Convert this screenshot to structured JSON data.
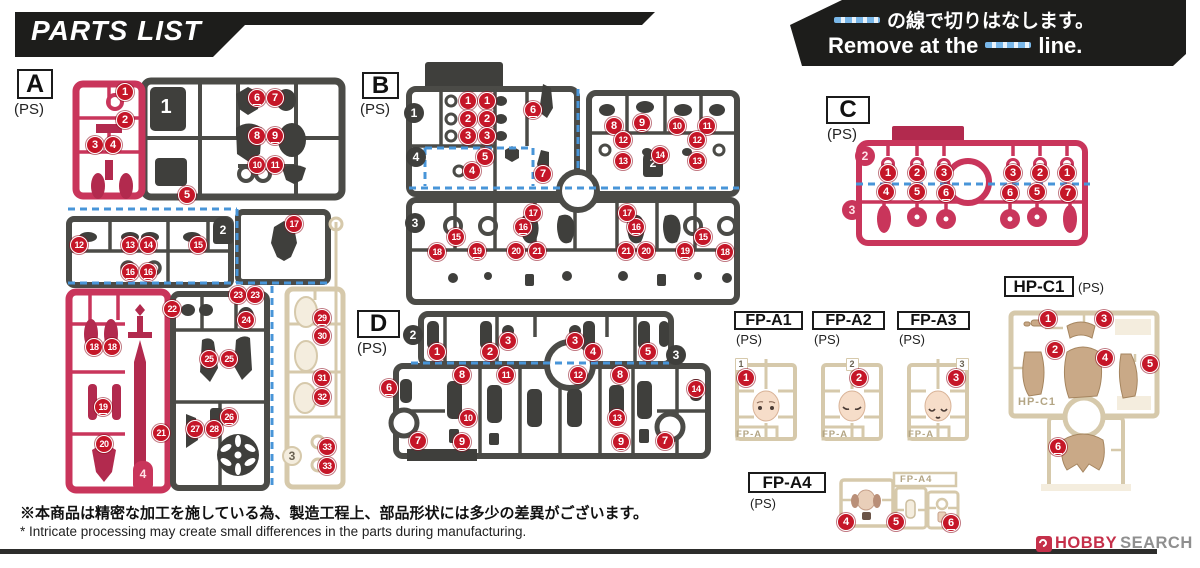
{
  "header": {
    "title": "PARTS LIST",
    "cut_note": {
      "jp": "の線で切りはなします。",
      "en_before": "Remove at the",
      "en_after": "line."
    }
  },
  "colors": {
    "pink": "#c9355b",
    "pink_dark": "#b22a4e",
    "dark": "#4b4b47",
    "dark_part": "#3f3f3c",
    "cream": "#d6c9ab",
    "cream_fill": "#f4edde",
    "skin": "#f6ddc9",
    "hair": "#c9a987",
    "marker": "#c51628",
    "cut_line": "#4895d8",
    "banner": "#1d1d1b",
    "logo_red": "#c5304a",
    "logo_gray": "#8f8f8f"
  },
  "labels": {
    "A": {
      "t": "A",
      "ps": "(PS)"
    },
    "B": {
      "t": "B",
      "ps": "(PS)"
    },
    "C": {
      "t": "C",
      "ps": "(PS)"
    },
    "D": {
      "t": "D",
      "ps": "(PS)"
    },
    "FPA1": {
      "t": "FP-A1",
      "ps": "(PS)"
    },
    "FPA2": {
      "t": "FP-A2",
      "ps": "(PS)"
    },
    "FPA3": {
      "t": "FP-A3",
      "ps": "(PS)"
    },
    "FPA4": {
      "t": "FP-A4",
      "ps": "(PS)"
    },
    "HPC1": {
      "t": "HP-C1",
      "ps": "(PS)"
    }
  },
  "molded_texts": [
    {
      "text": "FP-A",
      "x": 736,
      "y": 429
    },
    {
      "text": "FP-A",
      "x": 822,
      "y": 429
    },
    {
      "text": "FP-A",
      "x": 908,
      "y": 429
    },
    {
      "text": "FP-A4",
      "x": 900,
      "y": 474
    },
    {
      "text": "HP-C1",
      "x": 1018,
      "y": 396
    }
  ],
  "tags": [
    {
      "r": "A",
      "n": "1",
      "shape": "square",
      "color": "dark",
      "x": 166,
      "y": 107
    },
    {
      "r": "A",
      "n": "2",
      "shape": "tomb",
      "color": "dark",
      "x": 223,
      "y": 230
    },
    {
      "r": "A",
      "n": "3",
      "shape": "circle",
      "color": "cream",
      "x": 292,
      "y": 456
    },
    {
      "r": "A",
      "n": "4",
      "shape": "tomb",
      "color": "pink",
      "x": 143,
      "y": 474
    },
    {
      "r": "B",
      "n": "1",
      "shape": "circle",
      "color": "dark",
      "x": 414,
      "y": 113
    },
    {
      "r": "B",
      "n": "4",
      "shape": "circle",
      "color": "dark",
      "x": 416,
      "y": 157
    },
    {
      "r": "B",
      "n": "2",
      "shape": "tomb",
      "color": "dark",
      "x": 653,
      "y": 163
    },
    {
      "r": "B",
      "n": "3",
      "shape": "circle",
      "color": "dark",
      "x": 415,
      "y": 223
    },
    {
      "r": "C",
      "n": "2",
      "shape": "circle",
      "color": "pink",
      "x": 865,
      "y": 156
    },
    {
      "r": "C",
      "n": "3",
      "shape": "circle",
      "color": "pink",
      "x": 852,
      "y": 210
    },
    {
      "r": "D",
      "n": "2",
      "shape": "circle",
      "color": "dark",
      "x": 413,
      "y": 335
    },
    {
      "r": "D",
      "n": "3",
      "shape": "circle",
      "color": "dark",
      "x": 676,
      "y": 355
    },
    {
      "r": "FP-A1",
      "n": "1",
      "shape": "chip",
      "color": "chipc",
      "x": 741,
      "y": 364
    },
    {
      "r": "FP-A2",
      "n": "2",
      "shape": "chip",
      "color": "chipc",
      "x": 852,
      "y": 364
    },
    {
      "r": "FP-A3",
      "n": "3",
      "shape": "chip",
      "color": "chipc",
      "x": 962,
      "y": 364
    }
  ],
  "markers": [
    {
      "r": "A",
      "n": "1",
      "x": 125,
      "y": 92
    },
    {
      "r": "A",
      "n": "2",
      "x": 125,
      "y": 120
    },
    {
      "r": "A",
      "n": "3",
      "x": 95,
      "y": 145
    },
    {
      "r": "A",
      "n": "4",
      "x": 113,
      "y": 145
    },
    {
      "r": "A",
      "n": "5",
      "x": 187,
      "y": 195
    },
    {
      "r": "A",
      "n": "6",
      "x": 257,
      "y": 98
    },
    {
      "r": "A",
      "n": "7",
      "x": 275,
      "y": 98
    },
    {
      "r": "A",
      "n": "8",
      "x": 257,
      "y": 136
    },
    {
      "r": "A",
      "n": "9",
      "x": 275,
      "y": 136
    },
    {
      "r": "A",
      "n": "10",
      "x": 257,
      "y": 165
    },
    {
      "r": "A",
      "n": "11",
      "x": 275,
      "y": 165
    },
    {
      "r": "A",
      "n": "12",
      "x": 79,
      "y": 245
    },
    {
      "r": "A",
      "n": "13",
      "x": 130,
      "y": 245
    },
    {
      "r": "A",
      "n": "14",
      "x": 148,
      "y": 245
    },
    {
      "r": "A",
      "n": "15",
      "x": 198,
      "y": 245
    },
    {
      "r": "A",
      "n": "16",
      "x": 130,
      "y": 272
    },
    {
      "r": "A",
      "n": "16",
      "x": 148,
      "y": 272
    },
    {
      "r": "A",
      "n": "17",
      "x": 294,
      "y": 224
    },
    {
      "r": "A",
      "n": "18",
      "x": 94,
      "y": 347
    },
    {
      "r": "A",
      "n": "18",
      "x": 112,
      "y": 347
    },
    {
      "r": "A",
      "n": "19",
      "x": 103,
      "y": 407
    },
    {
      "r": "A",
      "n": "20",
      "x": 104,
      "y": 444
    },
    {
      "r": "A",
      "n": "21",
      "x": 161,
      "y": 433
    },
    {
      "r": "A",
      "n": "22",
      "x": 172,
      "y": 309
    },
    {
      "r": "A",
      "n": "23",
      "x": 238,
      "y": 295
    },
    {
      "r": "A",
      "n": "23",
      "x": 255,
      "y": 295
    },
    {
      "r": "A",
      "n": "24",
      "x": 246,
      "y": 320
    },
    {
      "r": "A",
      "n": "25",
      "x": 209,
      "y": 359
    },
    {
      "r": "A",
      "n": "25",
      "x": 229,
      "y": 359
    },
    {
      "r": "A",
      "n": "26",
      "x": 229,
      "y": 417
    },
    {
      "r": "A",
      "n": "27",
      "x": 195,
      "y": 429
    },
    {
      "r": "A",
      "n": "28",
      "x": 214,
      "y": 429
    },
    {
      "r": "A",
      "n": "29",
      "x": 322,
      "y": 318
    },
    {
      "r": "A",
      "n": "30",
      "x": 322,
      "y": 336
    },
    {
      "r": "A",
      "n": "31",
      "x": 322,
      "y": 378
    },
    {
      "r": "A",
      "n": "32",
      "x": 322,
      "y": 397
    },
    {
      "r": "A",
      "n": "33",
      "x": 327,
      "y": 447
    },
    {
      "r": "A",
      "n": "33",
      "x": 327,
      "y": 466
    },
    {
      "r": "B",
      "n": "1",
      "x": 468,
      "y": 101
    },
    {
      "r": "B",
      "n": "1",
      "x": 487,
      "y": 101
    },
    {
      "r": "B",
      "n": "2",
      "x": 468,
      "y": 119
    },
    {
      "r": "B",
      "n": "2",
      "x": 487,
      "y": 119
    },
    {
      "r": "B",
      "n": "3",
      "x": 468,
      "y": 136
    },
    {
      "r": "B",
      "n": "3",
      "x": 487,
      "y": 136
    },
    {
      "r": "B",
      "n": "4",
      "x": 472,
      "y": 171
    },
    {
      "r": "B",
      "n": "5",
      "x": 485,
      "y": 157
    },
    {
      "r": "B",
      "n": "6",
      "x": 533,
      "y": 110
    },
    {
      "r": "B",
      "n": "7",
      "x": 543,
      "y": 174
    },
    {
      "r": "B",
      "n": "8",
      "x": 614,
      "y": 126
    },
    {
      "r": "B",
      "n": "9",
      "x": 642,
      "y": 123
    },
    {
      "r": "B",
      "n": "10",
      "x": 677,
      "y": 126
    },
    {
      "r": "B",
      "n": "11",
      "x": 707,
      "y": 126
    },
    {
      "r": "B",
      "n": "12",
      "x": 623,
      "y": 140
    },
    {
      "r": "B",
      "n": "12",
      "x": 697,
      "y": 140
    },
    {
      "r": "B",
      "n": "13",
      "x": 623,
      "y": 161
    },
    {
      "r": "B",
      "n": "13",
      "x": 697,
      "y": 161
    },
    {
      "r": "B",
      "n": "14",
      "x": 660,
      "y": 155
    },
    {
      "r": "B",
      "n": "15",
      "x": 456,
      "y": 237
    },
    {
      "r": "B",
      "n": "15",
      "x": 703,
      "y": 237
    },
    {
      "r": "B",
      "n": "16",
      "x": 523,
      "y": 227
    },
    {
      "r": "B",
      "n": "16",
      "x": 636,
      "y": 227
    },
    {
      "r": "B",
      "n": "17",
      "x": 533,
      "y": 213
    },
    {
      "r": "B",
      "n": "17",
      "x": 627,
      "y": 213
    },
    {
      "r": "B",
      "n": "18",
      "x": 437,
      "y": 252
    },
    {
      "r": "B",
      "n": "18",
      "x": 725,
      "y": 252
    },
    {
      "r": "B",
      "n": "19",
      "x": 477,
      "y": 251
    },
    {
      "r": "B",
      "n": "19",
      "x": 685,
      "y": 251
    },
    {
      "r": "B",
      "n": "20",
      "x": 516,
      "y": 251
    },
    {
      "r": "B",
      "n": "20",
      "x": 646,
      "y": 251
    },
    {
      "r": "B",
      "n": "21",
      "x": 537,
      "y": 251
    },
    {
      "r": "B",
      "n": "21",
      "x": 626,
      "y": 251
    },
    {
      "r": "C",
      "n": "1",
      "x": 888,
      "y": 173
    },
    {
      "r": "C",
      "n": "2",
      "x": 917,
      "y": 173
    },
    {
      "r": "C",
      "n": "3",
      "x": 944,
      "y": 173
    },
    {
      "r": "C",
      "n": "3",
      "x": 1013,
      "y": 173
    },
    {
      "r": "C",
      "n": "2",
      "x": 1040,
      "y": 173
    },
    {
      "r": "C",
      "n": "1",
      "x": 1067,
      "y": 173
    },
    {
      "r": "C",
      "n": "4",
      "x": 886,
      "y": 192
    },
    {
      "r": "C",
      "n": "5",
      "x": 917,
      "y": 192
    },
    {
      "r": "C",
      "n": "6",
      "x": 946,
      "y": 193
    },
    {
      "r": "C",
      "n": "6",
      "x": 1010,
      "y": 193
    },
    {
      "r": "C",
      "n": "5",
      "x": 1037,
      "y": 192
    },
    {
      "r": "C",
      "n": "7",
      "x": 1068,
      "y": 193
    },
    {
      "r": "D",
      "n": "1",
      "x": 437,
      "y": 352
    },
    {
      "r": "D",
      "n": "2",
      "x": 490,
      "y": 352
    },
    {
      "r": "D",
      "n": "3",
      "x": 508,
      "y": 341
    },
    {
      "r": "D",
      "n": "3",
      "x": 575,
      "y": 341
    },
    {
      "r": "D",
      "n": "4",
      "x": 593,
      "y": 352
    },
    {
      "r": "D",
      "n": "5",
      "x": 648,
      "y": 352
    },
    {
      "r": "D",
      "n": "6",
      "x": 389,
      "y": 388
    },
    {
      "r": "D",
      "n": "7",
      "x": 418,
      "y": 441
    },
    {
      "r": "D",
      "n": "7",
      "x": 665,
      "y": 441
    },
    {
      "r": "D",
      "n": "8",
      "x": 462,
      "y": 375
    },
    {
      "r": "D",
      "n": "8",
      "x": 620,
      "y": 375
    },
    {
      "r": "D",
      "n": "9",
      "x": 462,
      "y": 442
    },
    {
      "r": "D",
      "n": "9",
      "x": 621,
      "y": 442
    },
    {
      "r": "D",
      "n": "10",
      "x": 468,
      "y": 418
    },
    {
      "r": "D",
      "n": "11",
      "x": 506,
      "y": 375
    },
    {
      "r": "D",
      "n": "12",
      "x": 578,
      "y": 375
    },
    {
      "r": "D",
      "n": "13",
      "x": 617,
      "y": 418
    },
    {
      "r": "D",
      "n": "14",
      "x": 696,
      "y": 389
    },
    {
      "r": "FP-A1",
      "n": "1",
      "x": 746,
      "y": 378
    },
    {
      "r": "FP-A2",
      "n": "2",
      "x": 859,
      "y": 378
    },
    {
      "r": "FP-A3",
      "n": "3",
      "x": 956,
      "y": 378
    },
    {
      "r": "FP-A4",
      "n": "4",
      "x": 846,
      "y": 522
    },
    {
      "r": "FP-A4",
      "n": "5",
      "x": 896,
      "y": 522
    },
    {
      "r": "FP-A4",
      "n": "6",
      "x": 951,
      "y": 523
    },
    {
      "r": "HP-C1",
      "n": "1",
      "x": 1048,
      "y": 319
    },
    {
      "r": "HP-C1",
      "n": "2",
      "x": 1055,
      "y": 350
    },
    {
      "r": "HP-C1",
      "n": "3",
      "x": 1104,
      "y": 319
    },
    {
      "r": "HP-C1",
      "n": "4",
      "x": 1105,
      "y": 358
    },
    {
      "r": "HP-C1",
      "n": "5",
      "x": 1150,
      "y": 364
    },
    {
      "r": "HP-C1",
      "n": "6",
      "x": 1058,
      "y": 447
    }
  ],
  "footer": {
    "note_jp": "※本商品は精密な加工を施している為、製造工程上、部品形状には多少の差異がございます。",
    "note_en": "* Intricate processing may create small differences in the parts during manufacturing."
  },
  "watermark": {
    "brand": "HOBBY",
    "suffix": "SEARCH"
  }
}
